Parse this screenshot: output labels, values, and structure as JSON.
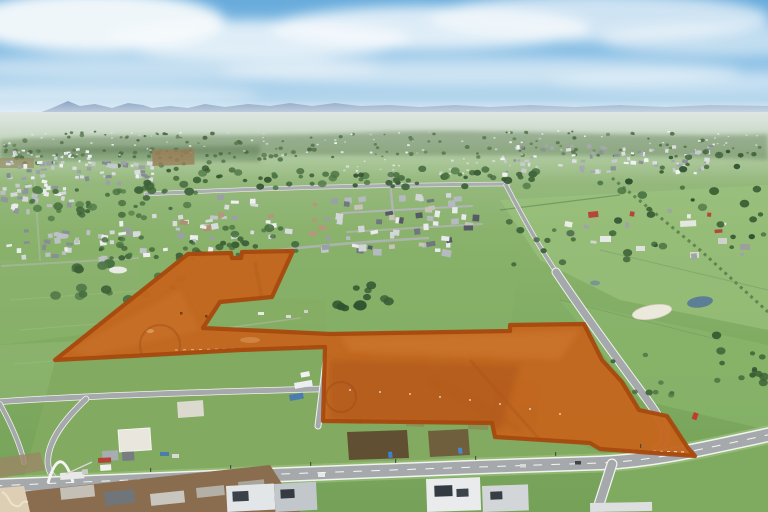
{
  "meta": {
    "type": "aerial-drone-photograph",
    "subject": "development land with highlighted sale parcel, suburban estates, rural paddocks and new roads"
  },
  "sky": {
    "top": "#67abdc",
    "mid": "#8ec2e6",
    "low": "#c2ddef",
    "horizon": "#dcecf6",
    "cloud": "#f6fafc"
  },
  "mountains": {
    "near": "#7590b4",
    "far": "#93abc6"
  },
  "terrain": {
    "haze": "#b7c9c0",
    "far_green": "#9abc85",
    "mid_green": "#83ad62",
    "near_green": "#75a258",
    "tree_dark": "#3c6036",
    "road_gray": "#a5a9ac",
    "road_edge": "#f2f2f0",
    "dirt_brown": "#8a6d4e"
  },
  "parcel_highlight": {
    "fill": "#c4661d",
    "opacity": "0.96",
    "stroke": "#a8490e",
    "stroke_width": "4.2",
    "points": "55,360 188,254 231,253 232,258 241,258 242,252 293,251 272,297 220,302 203,328 330,334 510,331 510,325 584,324 602,360 622,382 639,410 667,416 688,448 695,456 640,452 600,449 590,443 495,437 492,423 323,421 325,347 240,350 150,355"
  },
  "clusters": {
    "houses": [
      {
        "seed": 11,
        "x": 2,
        "y": 160,
        "w": 150,
        "h": 24,
        "n": 60,
        "s": 4,
        "palette": [
          "#eef0f1",
          "#dadddf",
          "#c4c9cd",
          "#9ba1a7",
          "#848b92"
        ]
      },
      {
        "seed": 12,
        "x": 0,
        "y": 184,
        "w": 72,
        "h": 28,
        "n": 32,
        "s": 4.5,
        "palette": [
          "#e9ebec",
          "#d5d8da",
          "#b9bec3",
          "#8f969c"
        ]
      },
      {
        "seed": 13,
        "x": 112,
        "y": 214,
        "w": 100,
        "h": 40,
        "n": 26,
        "s": 5,
        "palette": [
          "#eceeef",
          "#d8dbdd",
          "#c0c5c9",
          "#9aa0a6",
          "#b28e74"
        ]
      },
      {
        "seed": 14,
        "x": 0,
        "y": 228,
        "w": 118,
        "h": 32,
        "n": 30,
        "s": 5,
        "palette": [
          "#eaecee",
          "#d4d7d9",
          "#bcc1c5",
          "#878e94"
        ]
      },
      {
        "seed": 15,
        "x": 214,
        "y": 192,
        "w": 120,
        "h": 56,
        "n": 24,
        "s": 5,
        "palette": [
          "#eef0f1",
          "#d9dcde",
          "#c3c8cc",
          "#99a0a6",
          "#b8957c"
        ]
      },
      {
        "seed": 16,
        "x": 336,
        "y": 192,
        "w": 150,
        "h": 58,
        "n": 52,
        "s": 6,
        "palette": [
          "#e8eaeb",
          "#d3d6d9",
          "#b5bac0",
          "#70777f",
          "#555b63",
          "#c8c3ba"
        ]
      },
      {
        "seed": 17,
        "x": 490,
        "y": 143,
        "w": 220,
        "h": 30,
        "n": 85,
        "s": 3.6,
        "palette": [
          "#eff1f2",
          "#dcdfe1",
          "#c6cbcf",
          "#a3a9af",
          "#8b9298"
        ]
      },
      {
        "seed": 18,
        "x": 0,
        "y": 148,
        "w": 90,
        "h": 14,
        "n": 26,
        "s": 2.6,
        "palette": [
          "#f0f2f3",
          "#dde0e2",
          "#c8cdd1"
        ]
      },
      {
        "seed": 19,
        "x": 556,
        "y": 200,
        "w": 200,
        "h": 60,
        "n": 12,
        "s": 5,
        "palette": [
          "#eaece9",
          "#d2d5d2",
          "#9fa6a2",
          "#b5463b"
        ]
      }
    ],
    "trees": [
      {
        "seed": 31,
        "x": 140,
        "y": 168,
        "w": 400,
        "h": 20,
        "n": 70,
        "rmin": 2,
        "rmax": 4.5,
        "palette": [
          "#42663c",
          "#4d7544",
          "#375832"
        ]
      },
      {
        "seed": 32,
        "x": 28,
        "y": 186,
        "w": 170,
        "h": 34,
        "n": 40,
        "rmin": 2,
        "rmax": 5,
        "palette": [
          "#3f6339",
          "#4a7242",
          "#54804a"
        ]
      },
      {
        "seed": 33,
        "x": 88,
        "y": 236,
        "w": 120,
        "h": 24,
        "n": 20,
        "rmin": 2,
        "rmax": 4,
        "palette": [
          "#41653b",
          "#4c7443"
        ]
      },
      {
        "seed": 34,
        "x": 196,
        "y": 224,
        "w": 100,
        "h": 34,
        "n": 16,
        "rmin": 2.5,
        "rmax": 5,
        "palette": [
          "#3d6137",
          "#487041"
        ]
      },
      {
        "seed": 35,
        "x": 46,
        "y": 260,
        "w": 140,
        "h": 42,
        "n": 18,
        "rmin": 2.5,
        "rmax": 6,
        "palette": [
          "#3c6036",
          "#477040",
          "#52794a"
        ]
      },
      {
        "seed": 36,
        "x": 330,
        "y": 284,
        "w": 68,
        "h": 28,
        "n": 12,
        "rmin": 3,
        "rmax": 7,
        "palette": [
          "#2f5230",
          "#3a5f37"
        ]
      },
      {
        "seed": 37,
        "x": 600,
        "y": 150,
        "w": 168,
        "h": 110,
        "n": 40,
        "rmin": 2,
        "rmax": 5,
        "palette": [
          "#3e6338",
          "#4a7342",
          "#2f5230"
        ]
      },
      {
        "seed": 38,
        "x": 712,
        "y": 328,
        "w": 56,
        "h": 56,
        "n": 14,
        "rmin": 2.5,
        "rmax": 5.5,
        "palette": [
          "#375a33",
          "#43693c"
        ]
      },
      {
        "seed": 39,
        "x": 508,
        "y": 208,
        "w": 80,
        "h": 60,
        "n": 10,
        "rmin": 2,
        "rmax": 4.5,
        "palette": [
          "#40643a",
          "#4b7343"
        ]
      },
      {
        "seed": 40,
        "x": 188,
        "y": 238,
        "w": 60,
        "h": 18,
        "n": 8,
        "rmin": 2,
        "rmax": 4,
        "palette": [
          "#3d6137"
        ]
      },
      {
        "seed": 41,
        "x": 612,
        "y": 352,
        "w": 60,
        "h": 46,
        "n": 8,
        "rmin": 2,
        "rmax": 4,
        "palette": [
          "#44683d",
          "#507747"
        ]
      },
      {
        "layer": "far",
        "seed": 53,
        "x": 0,
        "y": 131,
        "w": 768,
        "h": 26,
        "n": 130,
        "rmin": 1,
        "rmax": 2.6,
        "palette": [
          "#5a7a50",
          "#4e6e46",
          "#66855a"
        ]
      },
      {
        "layer": "far",
        "seed": 54,
        "x": 0,
        "y": 150,
        "w": 300,
        "h": 16,
        "n": 40,
        "rmin": 1.5,
        "rmax": 3,
        "palette": [
          "#4e6e46",
          "#5a7a50"
        ]
      }
    ],
    "specks": [
      {
        "seed": 51,
        "x": 0,
        "y": 130,
        "w": 768,
        "h": 26,
        "n": 90,
        "s": 2,
        "palette": [
          "#e9eef0",
          "#f2f5f6",
          "#d8dfe2"
        ]
      },
      {
        "seed": 52,
        "x": 330,
        "y": 158,
        "w": 180,
        "h": 16,
        "n": 24,
        "s": 2.4,
        "palette": [
          "#eef1f2",
          "#dde2e4"
        ]
      }
    ]
  }
}
